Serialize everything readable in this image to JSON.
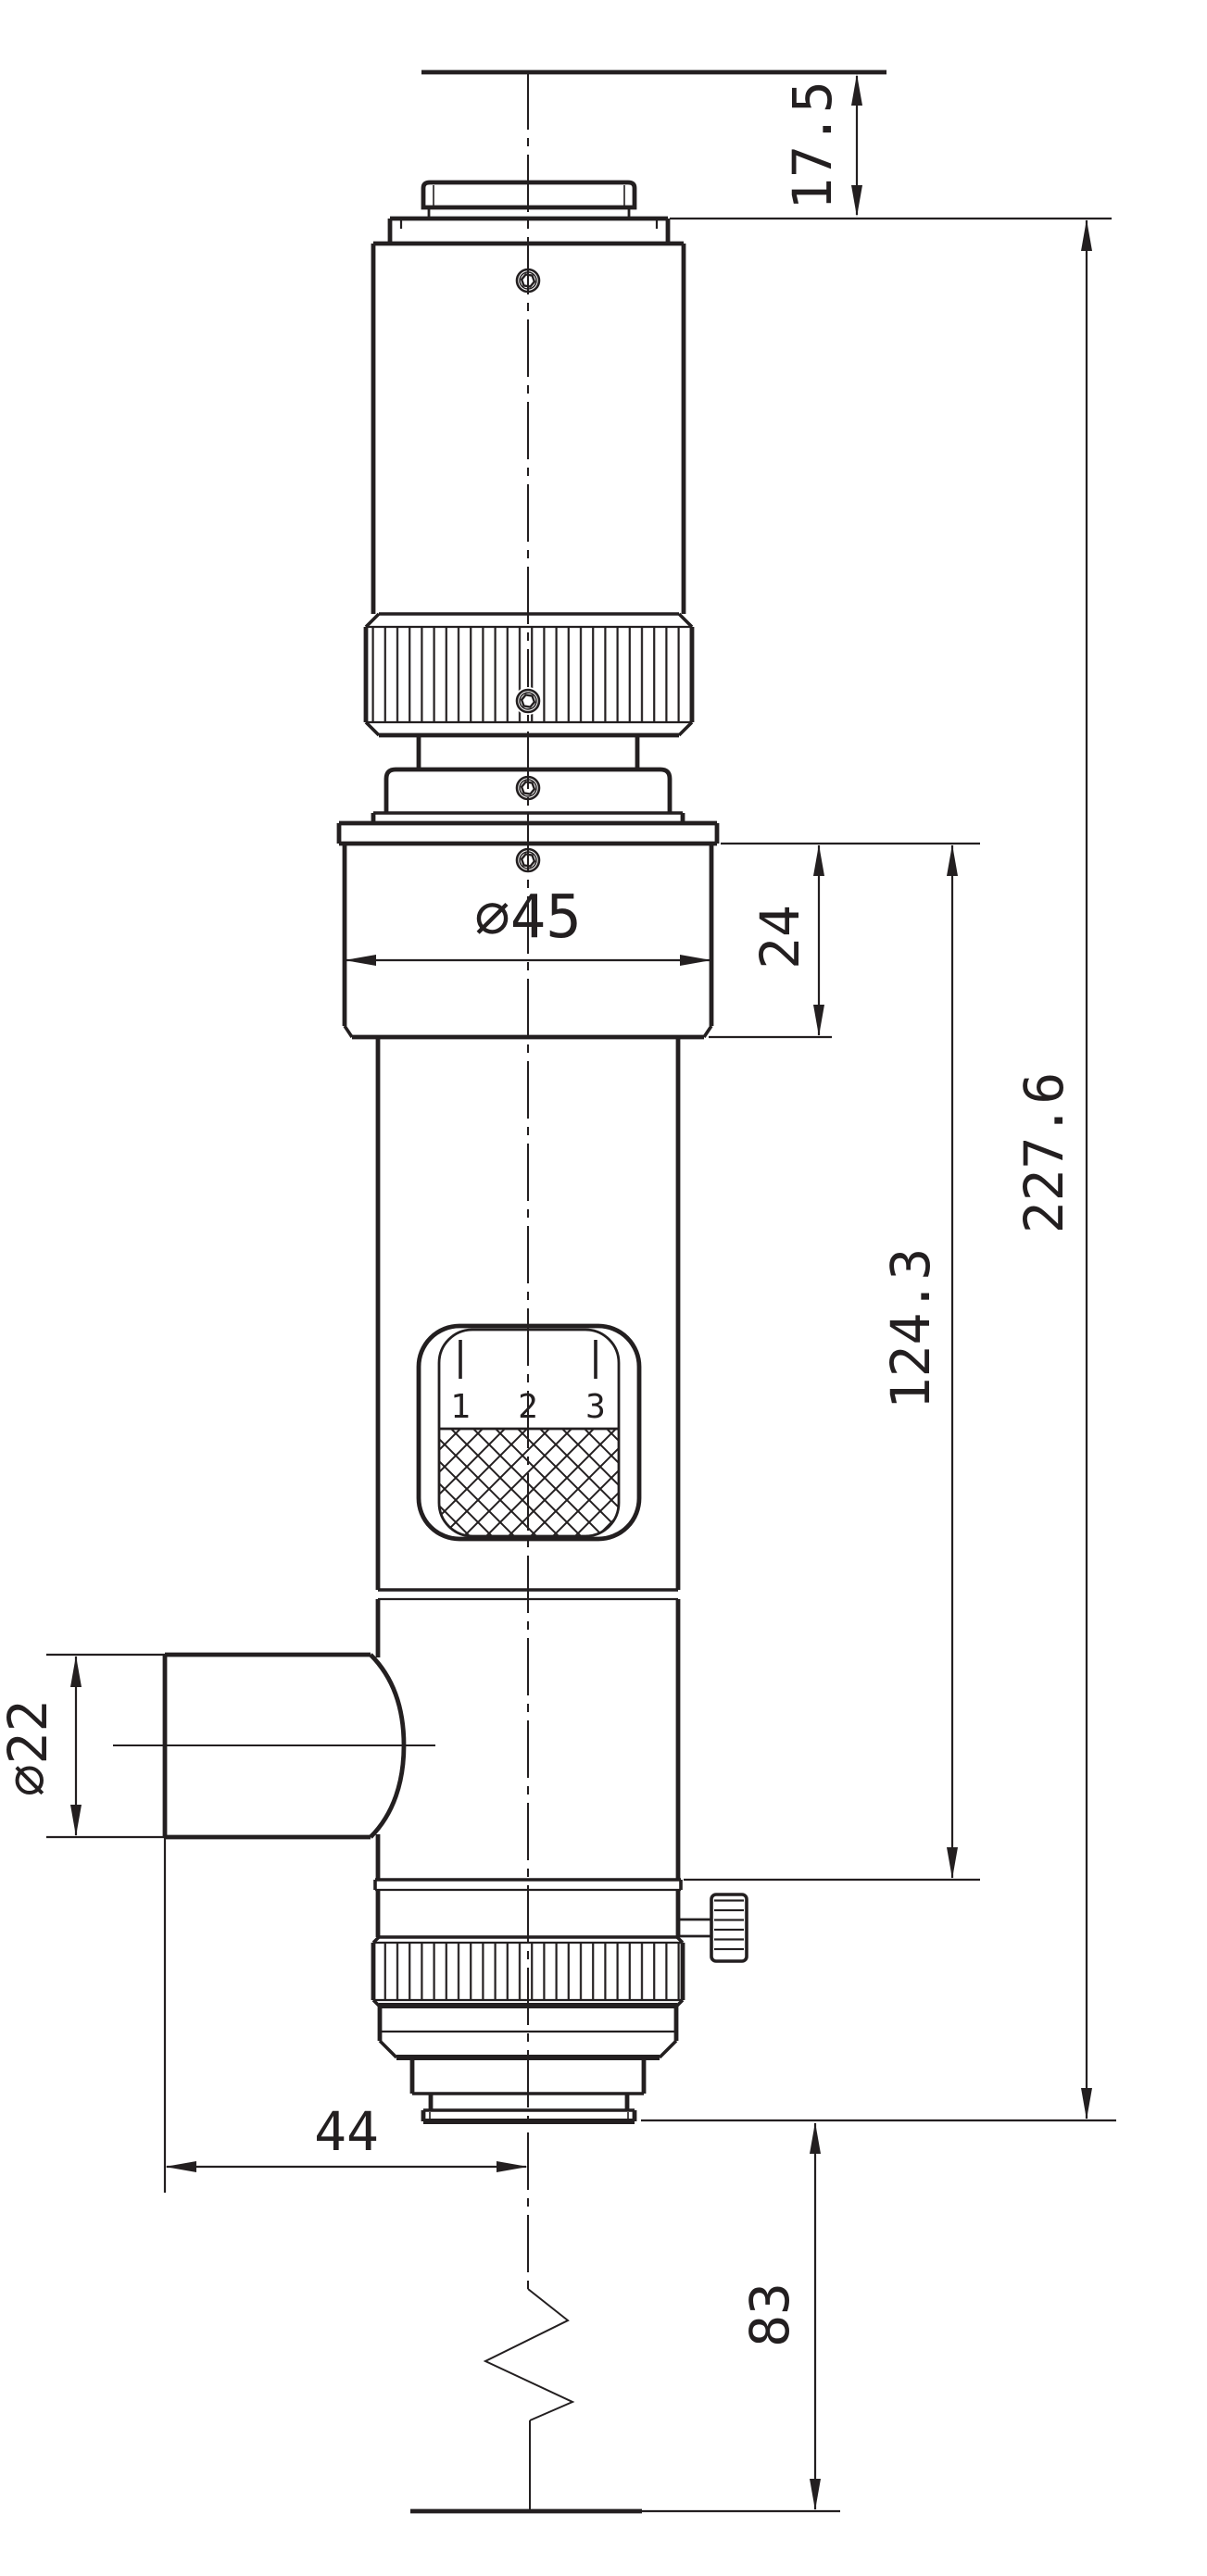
{
  "drawing": {
    "title": "optical-tube-outline-drawing",
    "colors": {
      "line": "#231f20",
      "background": "#ffffff"
    },
    "dimensions": {
      "top_offset": "17.5",
      "upper_section_height": "24",
      "body_height": "124.3",
      "total_height": "227.6",
      "upper_diameter": "∅45",
      "port_diameter": "∅22",
      "port_length": "44",
      "bottom_extension": "83"
    },
    "window": {
      "scale_labels": [
        "1",
        "2",
        "3"
      ]
    }
  }
}
